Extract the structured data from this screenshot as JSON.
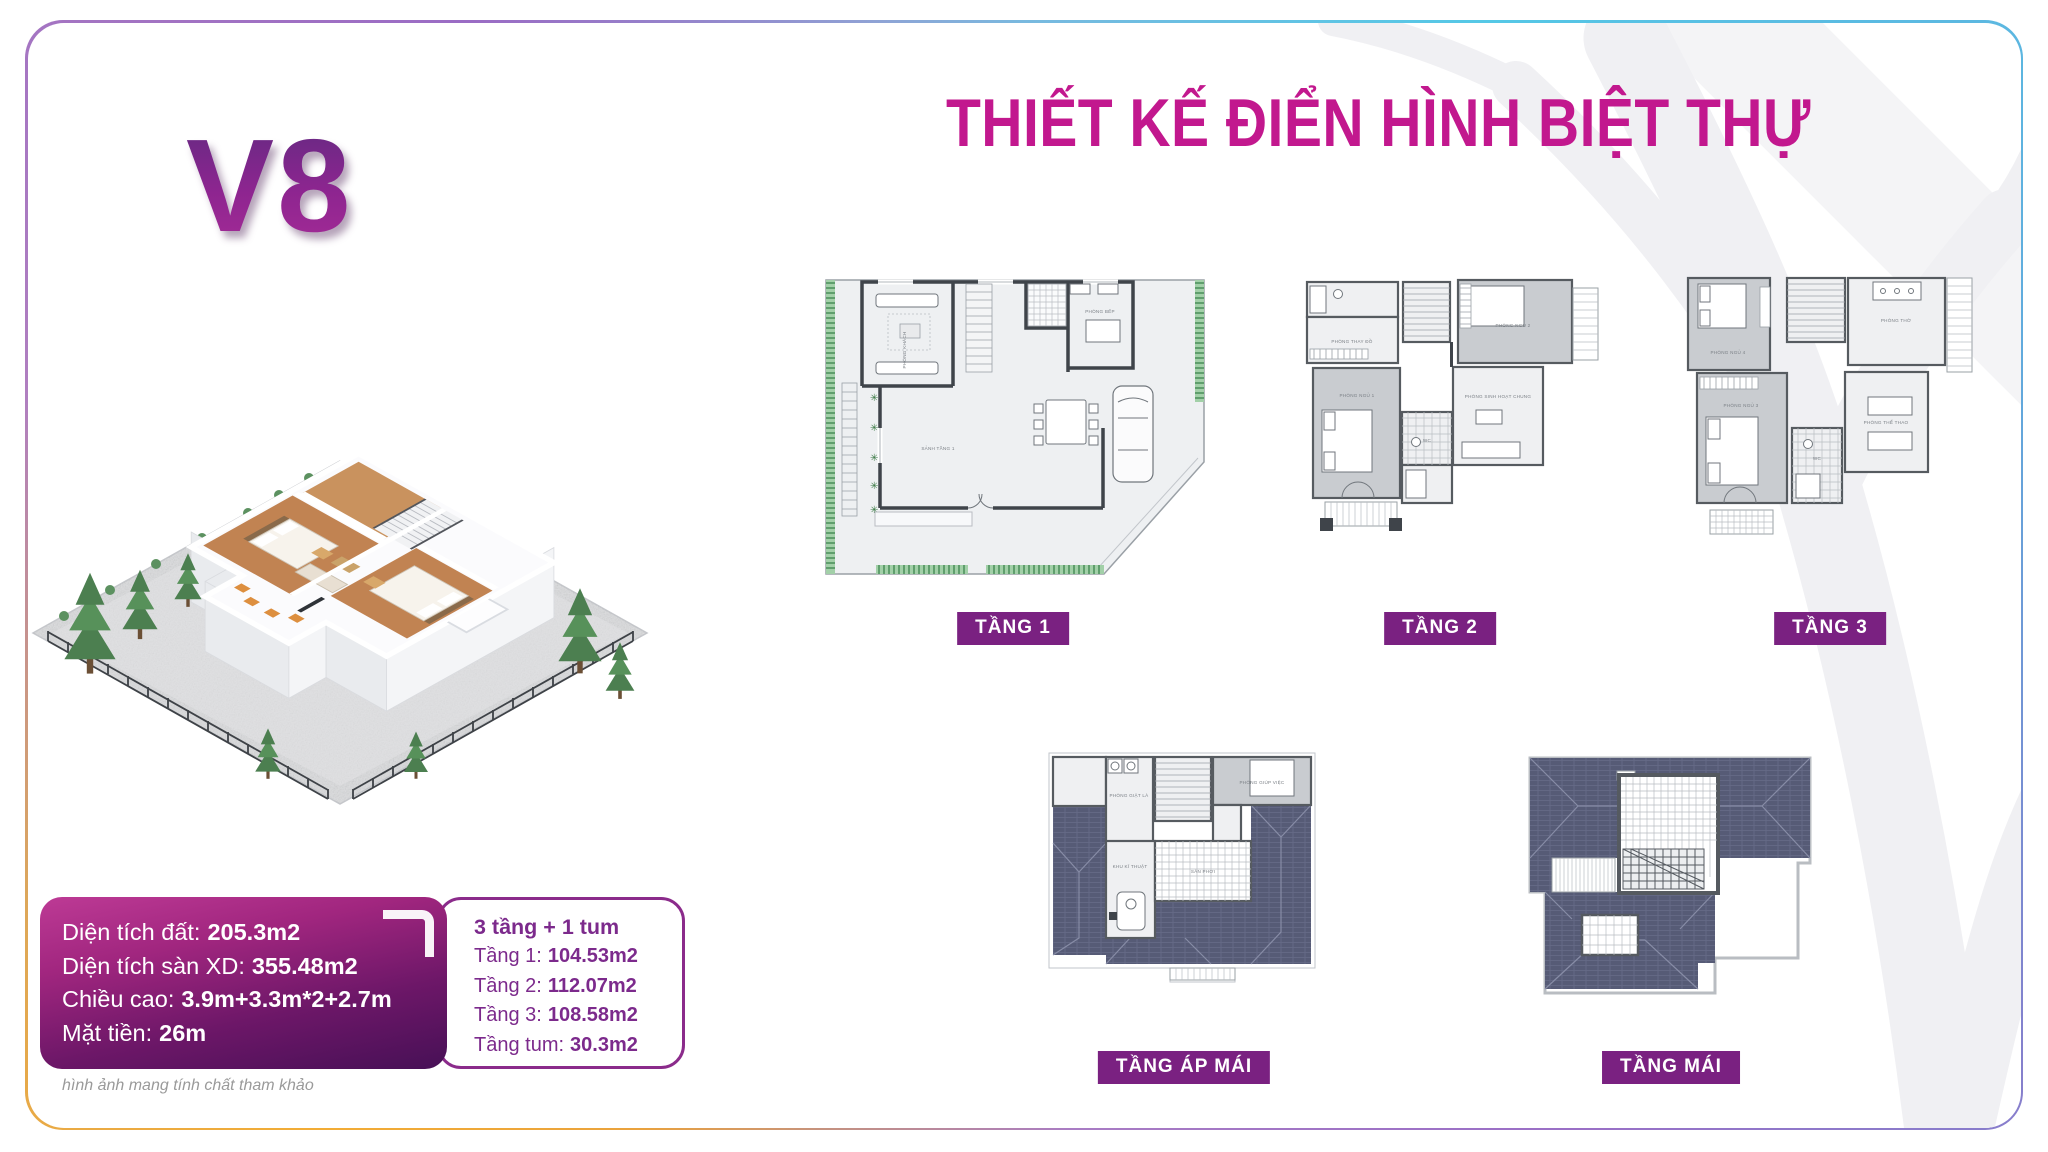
{
  "page": {
    "model": "V8",
    "title": "THIẾT KẾ ĐIỂN HÌNH BIỆT THỰ",
    "disclaimer": "hình ảnh mang tính chất tham khảo"
  },
  "specs": {
    "rows": [
      {
        "label": "Diện tích đất:",
        "value": "205.3m2"
      },
      {
        "label": "Diện tích sàn XD:",
        "value": "355.48m2"
      },
      {
        "label": "Chiều cao:",
        "value": "3.9m+3.3m*2+2.7m"
      },
      {
        "label": "Mặt tiền:",
        "value": "26m"
      }
    ]
  },
  "areas": {
    "heading": "3 tầng + 1 tum",
    "rows": [
      {
        "label": "Tầng 1:",
        "value": "104.53m2"
      },
      {
        "label": "Tầng 2:",
        "value": "112.07m2"
      },
      {
        "label": "Tầng 3:",
        "value": "108.58m2"
      },
      {
        "label": "Tầng tum:",
        "value": "30.3m2"
      }
    ]
  },
  "floor_plans": [
    {
      "id": "tang-1",
      "label": "TẦNG 1",
      "rooms": [
        "PHÒNG KHÁCH",
        "PHÒNG BẾP",
        "SẢNH TẦNG 1"
      ]
    },
    {
      "id": "tang-2",
      "label": "TẦNG 2",
      "rooms": [
        "PHÒNG THAY ĐỒ",
        "PHÒNG NGỦ 1",
        "PHÒNG NGỦ 2",
        "PHÒNG SINH HOẠT CHUNG",
        "WC"
      ]
    },
    {
      "id": "tang-3",
      "label": "TẦNG 3",
      "rooms": [
        "PHÒNG NGỦ 4",
        "PHÒNG THỜ",
        "PHÒNG NGỦ 3",
        "PHÒNG THỂ THAO",
        "WC"
      ]
    },
    {
      "id": "tang-ap-mai",
      "label": "TẦNG ÁP MÁI",
      "rooms": [
        "PHÒNG GIẶT LÀ",
        "PHÒNG GIÚP VIỆC",
        "KHU KĨ THUẬT",
        "SÂN PHƠI"
      ]
    },
    {
      "id": "tang-mai",
      "label": "TẦNG MÁI",
      "rooms": []
    }
  ],
  "colors": {
    "title_magenta": "#c2188e",
    "label_purple": "#7a2181",
    "spec_gradient_top": "#bd3a95",
    "spec_gradient_bottom": "#471056",
    "border_cyan": "#55c8e6",
    "border_purple": "#9a6cc4",
    "border_yellow": "#f2ac35",
    "hedge_green": "#8cc598",
    "roof_slate": "#565b76"
  }
}
